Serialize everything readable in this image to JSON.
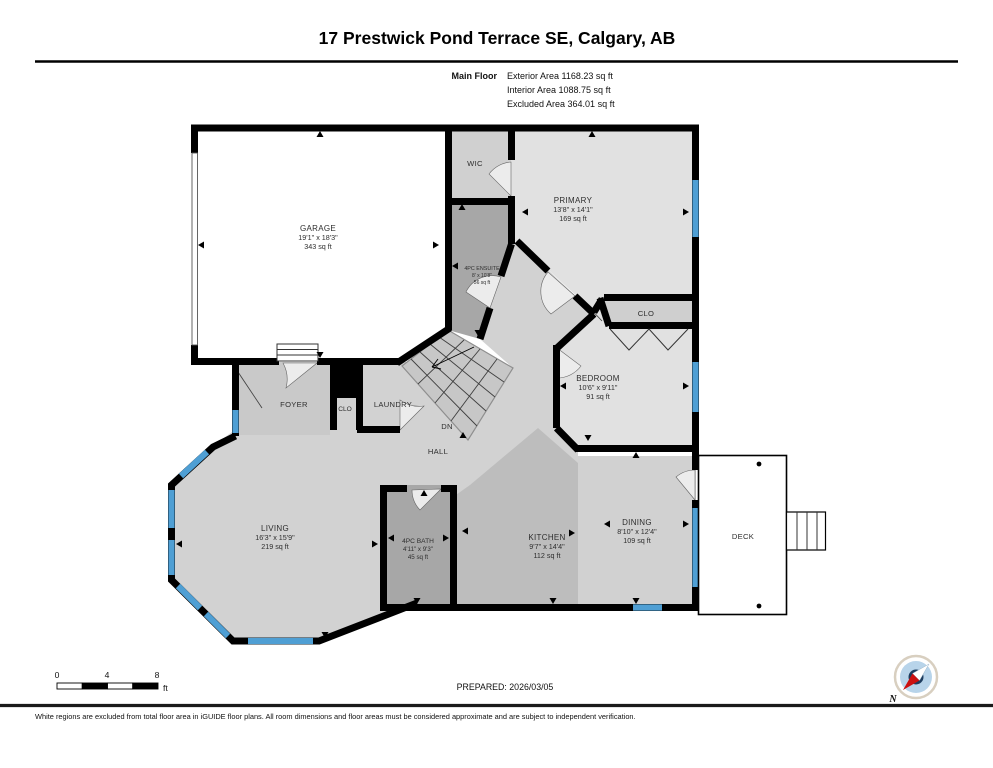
{
  "header": {
    "title": "17 Prestwick Pond Terrace SE, Calgary, AB",
    "floor_label": "Main Floor",
    "exterior_area": "Exterior Area 1168.23 sq ft",
    "interior_area": "Interior Area 1088.75 sq ft",
    "excluded_area": "Excluded Area 364.01 sq ft"
  },
  "rooms": {
    "garage": {
      "name": "GARAGE",
      "dims": "19'1\" x 18'3\"",
      "area": "343 sq ft"
    },
    "wic": {
      "name": "WIC"
    },
    "primary": {
      "name": "PRIMARY",
      "dims": "13'8\" x 14'1\"",
      "area": "169 sq ft"
    },
    "ensuite": {
      "name": "4PC ENSUITE",
      "dims": "8' x 10'8\"",
      "area": "56 sq ft"
    },
    "clo_primary": {
      "name": "CLO"
    },
    "bedroom": {
      "name": "BEDROOM",
      "dims": "10'6\" x 9'11\"",
      "area": "91 sq ft"
    },
    "foyer": {
      "name": "FOYER"
    },
    "clo_foyer": {
      "name": "CLO"
    },
    "laundry": {
      "name": "LAUNDRY"
    },
    "stairs_dn": {
      "name": "DN"
    },
    "hall": {
      "name": "HALL"
    },
    "living": {
      "name": "LIVING",
      "dims": "16'3\" x 15'9\"",
      "area": "219 sq ft"
    },
    "bath": {
      "name": "4PC BATH",
      "dims": "4'11\" x 9'3\"",
      "area": "45 sq ft"
    },
    "kitchen": {
      "name": "KITCHEN",
      "dims": "9'7\" x 14'4\"",
      "area": "112 sq ft"
    },
    "dining": {
      "name": "DINING",
      "dims": "8'10\" x 12'4\"",
      "area": "109 sq ft"
    },
    "deck": {
      "name": "DECK"
    }
  },
  "scale_bar": {
    "tick_0": "0",
    "tick_4": "4",
    "tick_8": "8",
    "unit": "ft"
  },
  "compass": {
    "north_label": "N"
  },
  "footer": {
    "prepared": "PREPARED: 2026/03/05",
    "disclaimer": "White regions are excluded from total floor area in iGUIDE floor plans. All room dimensions and floor areas must be considered approximate and are subject to independent verification."
  },
  "colors": {
    "wall": "#000000",
    "window": "#4f9fd4",
    "excluded_white": "#ffffff",
    "room_light": "#e1e1e1",
    "room_mid": "#d2d2d2",
    "kitchen_gray": "#bdbdbd",
    "dark_gray": "#a7a7a7",
    "stairs_gray": "#c7c7c7"
  }
}
